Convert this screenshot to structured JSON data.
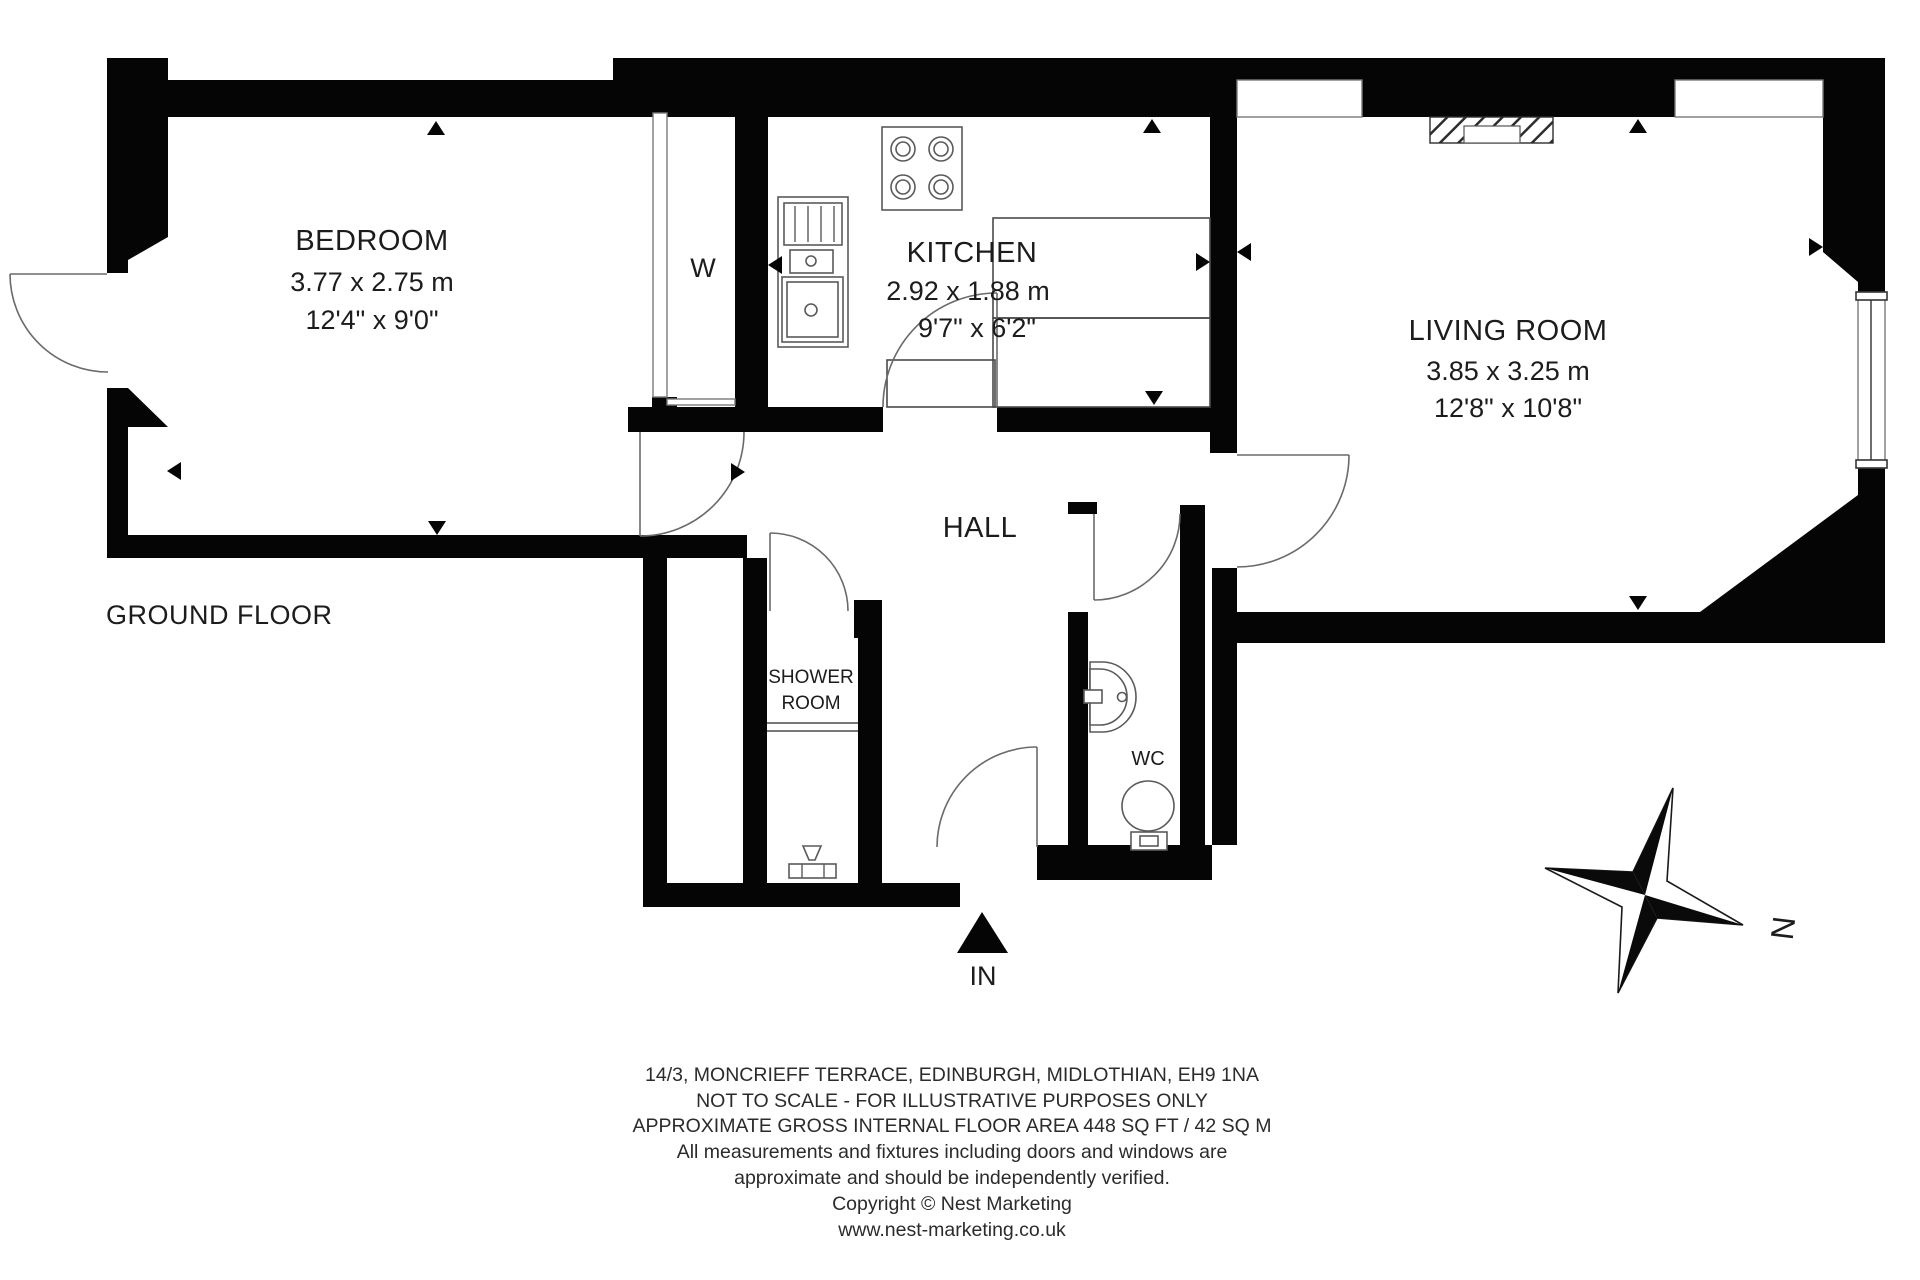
{
  "plan": {
    "floor_label": "GROUND FLOOR",
    "entrance_label": "IN",
    "compass": {
      "north_label": "N"
    }
  },
  "rooms": {
    "bedroom": {
      "name": "BEDROOM",
      "metric": "3.77 x 2.75 m",
      "imperial": "12'4\" x 9'0\""
    },
    "kitchen": {
      "name": "KITCHEN",
      "metric": "2.92 x 1.88 m",
      "imperial": "9'7\" x 6'2\""
    },
    "living_room": {
      "name": "LIVING ROOM",
      "metric": "3.85 x 3.25 m",
      "imperial": "12'8\" x 10'8\""
    },
    "hall": {
      "name": "HALL"
    },
    "shower_room": {
      "line1": "SHOWER",
      "line2": "ROOM"
    },
    "wc": {
      "name": "WC"
    },
    "wardrobe": {
      "name": "W"
    }
  },
  "footer": {
    "lines": [
      "14/3, MONCRIEFF TERRACE, EDINBURGH, MIDLOTHIAN, EH9 1NA",
      "NOT TO SCALE - FOR ILLUSTRATIVE PURPOSES ONLY",
      "APPROXIMATE GROSS INTERNAL FLOOR AREA 448 SQ FT / 42 SQ M",
      "All measurements and fixtures including doors and windows are",
      "approximate and should be independently verified.",
      "Copyright © Nest Marketing",
      "www.nest-marketing.co.uk"
    ]
  }
}
